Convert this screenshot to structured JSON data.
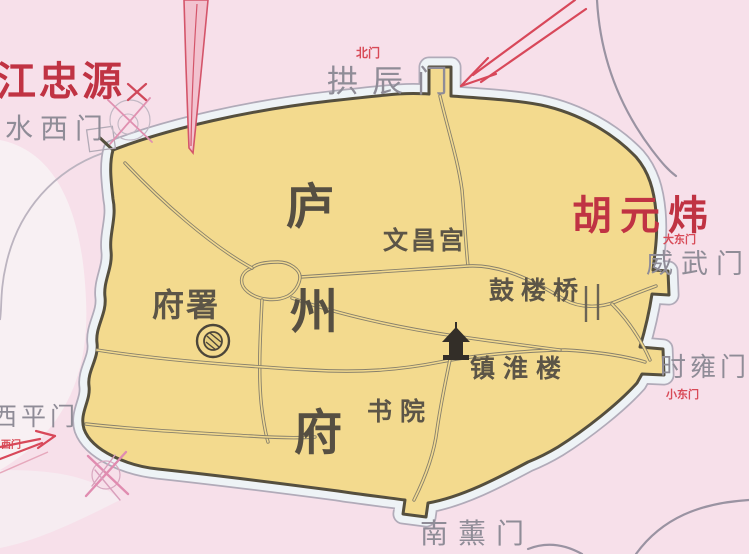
{
  "map": {
    "type": "historical-city-map",
    "labels": {
      "jiang": "江忠源",
      "hu": "胡元炜",
      "beimen": "北门",
      "gongchen": "拱辰门",
      "shuixi": "水西门",
      "weiwu": "威武门",
      "dadong": "大东门",
      "shiyong": "时雍门",
      "xiaodong": "小东门",
      "nanxun": "南薰门",
      "xiping": "西平门",
      "ximen": "西门",
      "lu": "庐",
      "zhou": "州",
      "fu": "府",
      "wenchang": "文昌宫",
      "gulouqiao": "鼓楼桥",
      "zhenhuai": "镇淮楼",
      "shuyuan": "书院",
      "fushu": "府署"
    },
    "colors": {
      "background_pink": "#f7e0ea",
      "city_fill": "#f3da8e",
      "wall": "#554f3e",
      "moat_fill": "#eef3f6",
      "moat_edge": "#b1abb9",
      "road": "#87806c",
      "river": "#9a93a2",
      "gate_text": "#8f8c97",
      "place_text": "#5c5547",
      "red_text": "#c03343",
      "arrow_red": "#d8485a"
    }
  }
}
